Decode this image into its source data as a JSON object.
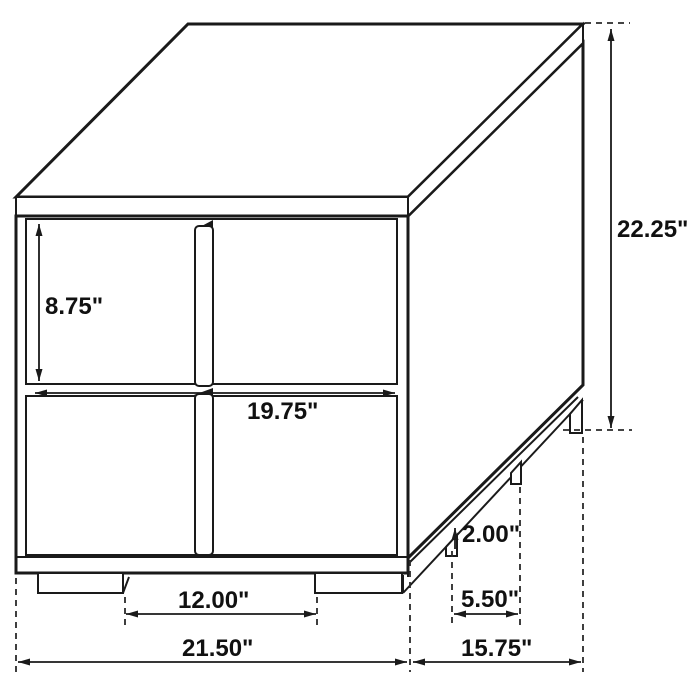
{
  "diagram": {
    "kind": "furniture-dimension-drawing",
    "colors": {
      "line": "#1a1a1a",
      "text": "#111111",
      "background": "#ffffff"
    },
    "dimensions": {
      "drawer_height": {
        "label": "8.75\""
      },
      "drawer_width": {
        "label": "19.75\""
      },
      "overall_height": {
        "label": "22.25\""
      },
      "front_leg_gap": {
        "label": "12.00\""
      },
      "leg_height": {
        "label": "2.00\""
      },
      "side_leg_gap": {
        "label": "5.50\""
      },
      "overall_width": {
        "label": "21.50\""
      },
      "overall_depth": {
        "label": "15.75\""
      }
    }
  }
}
